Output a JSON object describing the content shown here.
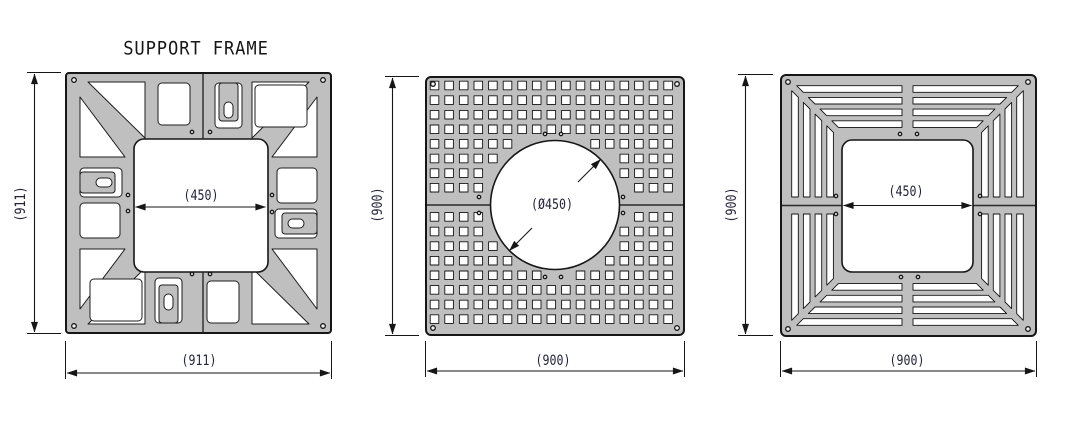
{
  "title": "SUPPORT FRAME",
  "figures": {
    "support_frame": {
      "name": "Support frame",
      "height_label": "(911)",
      "width_label": "(911)",
      "opening_label": "(450)"
    },
    "perforated_panel": {
      "name": "Perforated panel with round opening",
      "height_label": "(900)",
      "width_label": "(900)",
      "opening_label": "(Ø450)"
    },
    "slotted_panel": {
      "name": "Slotted grate panel with square opening",
      "height_label": "(900)",
      "width_label": "(900)",
      "opening_label": "(450)"
    }
  },
  "colors": {
    "background": "#ffffff",
    "plate_fill": "#bfbfbf",
    "line": "#161616",
    "dim_text": "#23233a"
  }
}
